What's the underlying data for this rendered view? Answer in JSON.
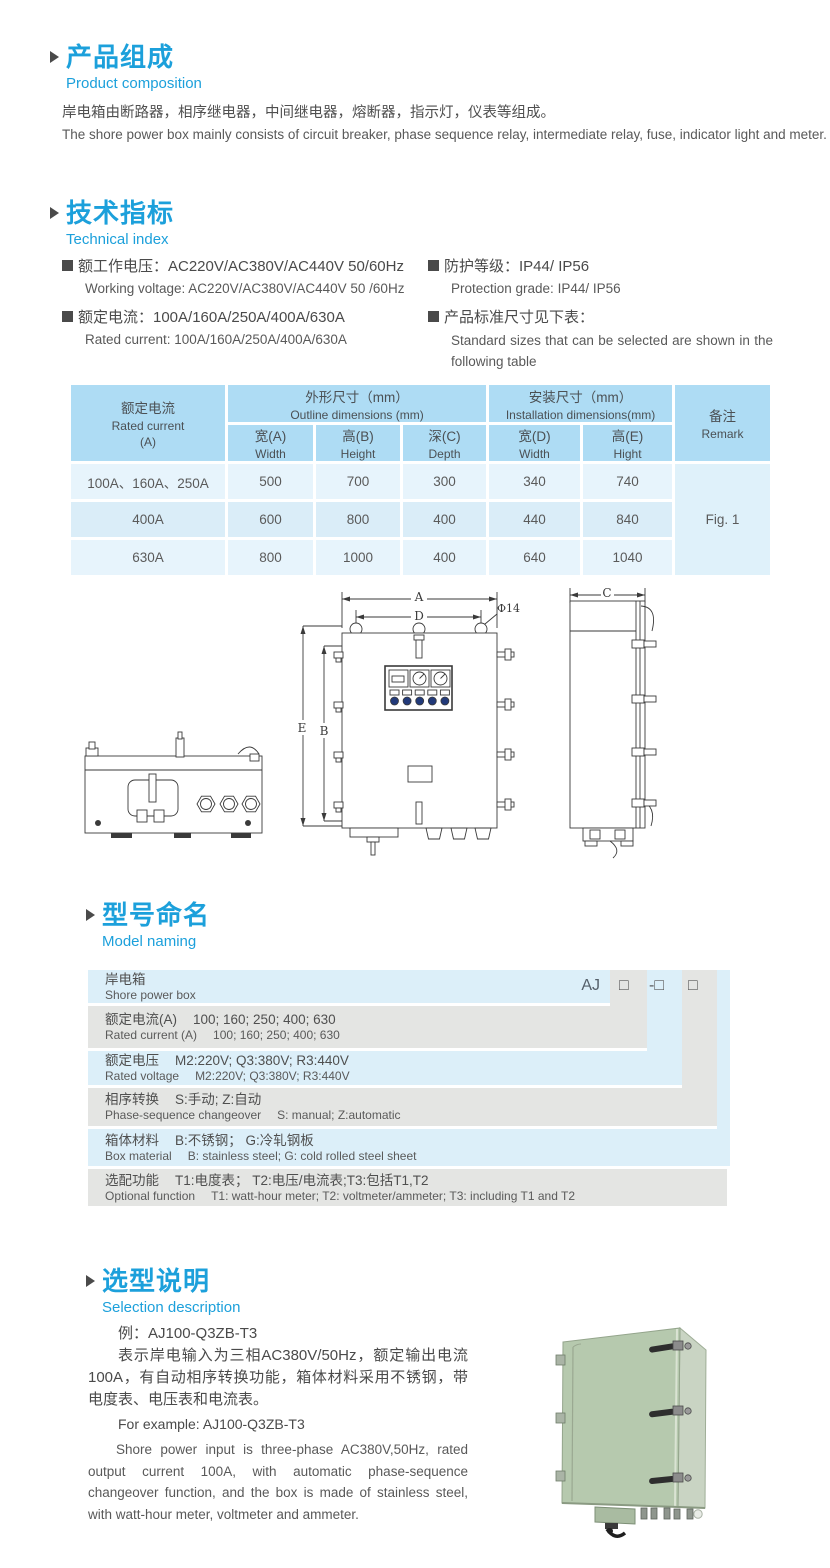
{
  "colors": {
    "accent": "#1CA0DB",
    "table_header_bg": "#AEDCF4",
    "table_row_light": "#E7F4FC",
    "table_row_mid": "#DAEDF8",
    "naming_blue": "#DCEFF9",
    "naming_gray": "#E4E5E3",
    "photo_green": "#B6C9AE"
  },
  "composition": {
    "title_cn": "产品组成",
    "title_en": "Product  composition",
    "body_cn": "岸电箱由断路器，相序继电器，中间继电器，熔断器，指示灯，仪表等组成。",
    "body_en": "The shore power box mainly consists of circuit breaker, phase sequence relay, intermediate relay, fuse, indicator light and meter."
  },
  "technical": {
    "title_cn": "技术指标",
    "title_en": "Technical index",
    "spec1_cn": "额工作电压：AC220V/AC380V/AC440V  50/60Hz",
    "spec1_en": "Working voltage: AC220V/AC380V/AC440V 50 /60Hz",
    "spec2_cn": "额定电流：100A/160A/250A/400A/630A",
    "spec2_en": "Rated current: 100A/160A/250A/400A/630A",
    "spec3_cn": "防护等级：IP44/ IP56",
    "spec3_en": "Protection grade: IP44/ IP56",
    "spec4_cn": "产品标准尺寸见下表：",
    "spec4_en": "Standard sizes that can be selected are shown in the following table"
  },
  "size_table": {
    "current_header_cn": "额定电流",
    "current_header_en": "Rated current",
    "current_header_unit": "(A)",
    "outline_cn": "外形尺寸（mm）",
    "outline_en": "Outline dimensions (mm)",
    "install_cn": "安装尺寸（mm）",
    "install_en": "Installation dimensions(mm)",
    "remark_cn": "备注",
    "remark_en": "Remark",
    "sub": [
      {
        "cn": "宽(A)",
        "en": "Width"
      },
      {
        "cn": "高(B)",
        "en": "Height"
      },
      {
        "cn": "深(C)",
        "en": "Depth"
      },
      {
        "cn": "宽(D)",
        "en": "Width"
      },
      {
        "cn": "高(E)",
        "en": "Hight"
      }
    ],
    "rows": [
      {
        "current": "100A、160A、250A",
        "v": [
          "500",
          "700",
          "300",
          "340",
          "740"
        ]
      },
      {
        "current": "400A",
        "v": [
          "600",
          "800",
          "400",
          "440",
          "840"
        ]
      },
      {
        "current": "630A",
        "v": [
          "800",
          "1000",
          "400",
          "640",
          "1040"
        ]
      }
    ],
    "remark_value": "Fig. 1"
  },
  "drawing": {
    "dim_a": "A",
    "dim_b": "B",
    "dim_c": "C",
    "dim_d": "D",
    "dim_e": "E",
    "hole": "Φ14"
  },
  "model_naming": {
    "title_cn": "型号命名",
    "title_en": "Model naming",
    "prefix": "AJ",
    "box1": "□",
    "box2": "-□",
    "box3": "□",
    "rows": [
      {
        "label_cn": "岸电箱",
        "value_cn": "",
        "label_en": "Shore power box",
        "value_en": ""
      },
      {
        "label_cn": "额定电流(A)",
        "value_cn": "100; 160; 250; 400; 630",
        "label_en": "Rated current (A)",
        "value_en": "100; 160; 250; 400; 630"
      },
      {
        "label_cn": "额定电压",
        "value_cn": "M2:220V;  Q3:380V;  R3:440V",
        "label_en": "Rated voltage",
        "value_en": "M2:220V;  Q3:380V;  R3:440V"
      },
      {
        "label_cn": "相序转换",
        "value_cn": "S:手动; Z:自动",
        "label_en": "Phase-sequence changeover",
        "value_en": "S: manual;  Z:automatic"
      },
      {
        "label_cn": "箱体材料",
        "value_cn": "B:不锈钢；  G:冷轧钢板",
        "label_en": "Box material",
        "value_en": "B: stainless steel; G: cold rolled steel sheet"
      },
      {
        "label_cn": "选配功能",
        "value_cn": "T1:电度表；  T2:电压/电流表;T3:包括T1,T2",
        "label_en": "Optional function",
        "value_en": "T1: watt-hour meter; T2: voltmeter/ammeter; T3: including T1 and T2"
      }
    ]
  },
  "selection": {
    "title_cn": "选型说明",
    "title_en": "Selection description",
    "example_cn": "例：AJ100-Q3ZB-T3",
    "body_cn": "表示岸电输入为三相AC380V/50Hz，额定输出电流100A，有自动相序转换功能，箱体材料采用不锈钢，带电度表、电压表和电流表。",
    "example_en": "For example: AJ100-Q3ZB-T3",
    "body_en": "Shore power input is three-phase AC380V,50Hz, rated output current 100A, with automatic phase-sequence changeover function, and the box is made of stainless steel, with watt-hour meter, voltmeter and ammeter."
  }
}
